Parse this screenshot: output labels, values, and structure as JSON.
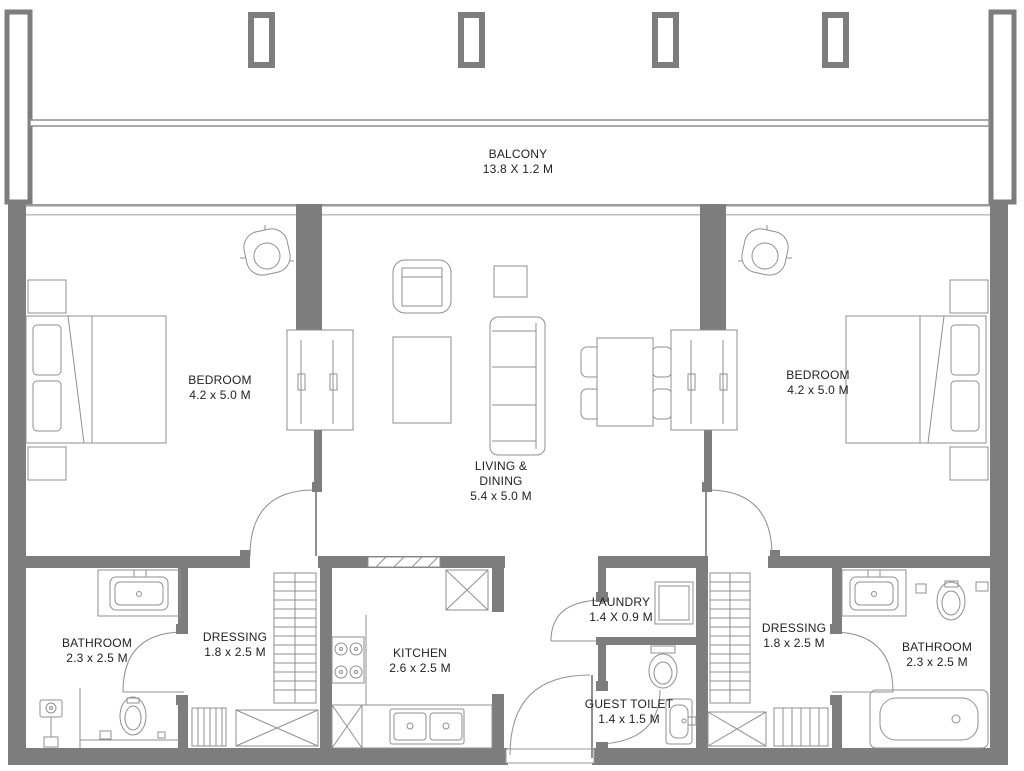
{
  "plan": {
    "type": "apartment-floor-plan",
    "colors": {
      "wall": "#7d7d7d",
      "line": "#8f8f8f",
      "text": "#222222",
      "background": "#ffffff"
    },
    "rooms": [
      {
        "id": "balcony",
        "name": "BALCONY",
        "dims": "13.8 X 1.2 M"
      },
      {
        "id": "bedroom-left",
        "name": "BEDROOM",
        "dims": "4.2 x 5.0 M"
      },
      {
        "id": "living-dining",
        "name": "LIVING &",
        "name2": "DINING",
        "dims": "5.4 x 5.0 M"
      },
      {
        "id": "bedroom-right",
        "name": "BEDROOM",
        "dims": "4.2 x 5.0 M"
      },
      {
        "id": "bathroom-left",
        "name": "BATHROOM",
        "dims": "2.3 x 2.5 M"
      },
      {
        "id": "dressing-left",
        "name": "DRESSING",
        "dims": "1.8 x 2.5 M"
      },
      {
        "id": "kitchen",
        "name": "KITCHEN",
        "dims": "2.6 x 2.5 M"
      },
      {
        "id": "laundry",
        "name": "LAUNDRY",
        "dims": "1.4 X 0.9 M"
      },
      {
        "id": "guest-toilet",
        "name": "GUEST TOILET",
        "dims": "1.4 x 1.5 M"
      },
      {
        "id": "dressing-right",
        "name": "DRESSING",
        "dims": "1.8 x 2.5 M"
      },
      {
        "id": "bathroom-right",
        "name": "BATHROOM",
        "dims": "2.3 x 2.5 M"
      }
    ]
  }
}
